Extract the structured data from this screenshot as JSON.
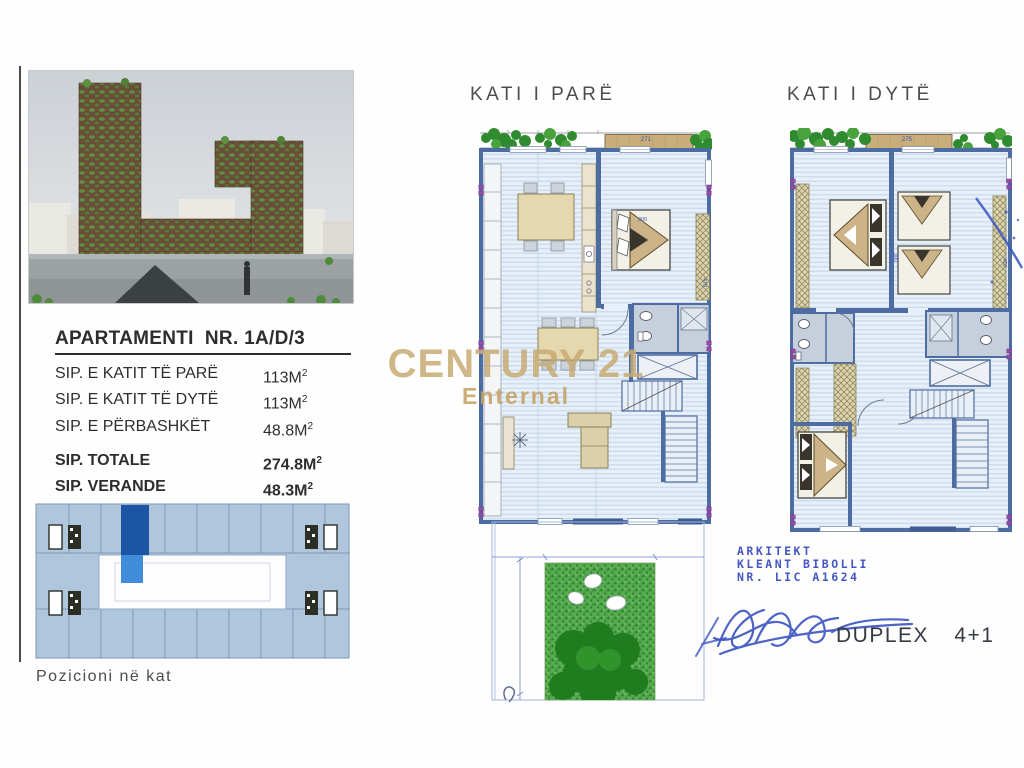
{
  "plans": {
    "first": {
      "title": "KATI I PARË",
      "deck_dim": "271",
      "dim_w": "300",
      "dim_h": "470"
    },
    "second": {
      "title": "KATI I DYTË",
      "deck_dim": "275",
      "dim_w": "300",
      "dim_h": "470"
    }
  },
  "left_panel": {
    "info": {
      "title": "APARTAMENTI  NR. 1A/D/3",
      "rows": [
        {
          "label": "SIP. E KATIT TË PARË",
          "value": "113M",
          "sup": "2"
        },
        {
          "label": "SIP. E KATIT TË DYTË",
          "value": "113M",
          "sup": "2"
        },
        {
          "label": "SIP. E PËRBASHKËT",
          "value": "48.8M",
          "sup": "2"
        },
        {
          "label": "SIP. TOTALE",
          "value": "274.8M",
          "sup": "2"
        },
        {
          "label": "SIP. VERANDE",
          "value": "48.3M",
          "sup": "2"
        }
      ]
    },
    "position_caption": "Pozicioni në kat"
  },
  "watermark": {
    "brand": "CENTURY 21",
    "office": "Enternal",
    "color": "#c9ad76"
  },
  "architect": {
    "role": "ARKITEKT",
    "name": "KLEANT BIBOLLI",
    "license": "NR. LIC A1624",
    "unit_type": "DUPLEX 4+1",
    "ink_color": "#3c55c2"
  },
  "colors": {
    "wall_blue": "#4d6da2",
    "floor_blue": "#e7eff8",
    "wood_tan": "#c9ae7c",
    "plant_green": "#2f8b2f",
    "garden_green": "#4aa245",
    "unit_highlight_dark": "#1d55a5",
    "unit_highlight_light": "#3f8dd9",
    "column_marker_purple": "#9a4aaa",
    "watermark_gold": "#c9ad76",
    "pen_blue": "#3c55c2"
  }
}
